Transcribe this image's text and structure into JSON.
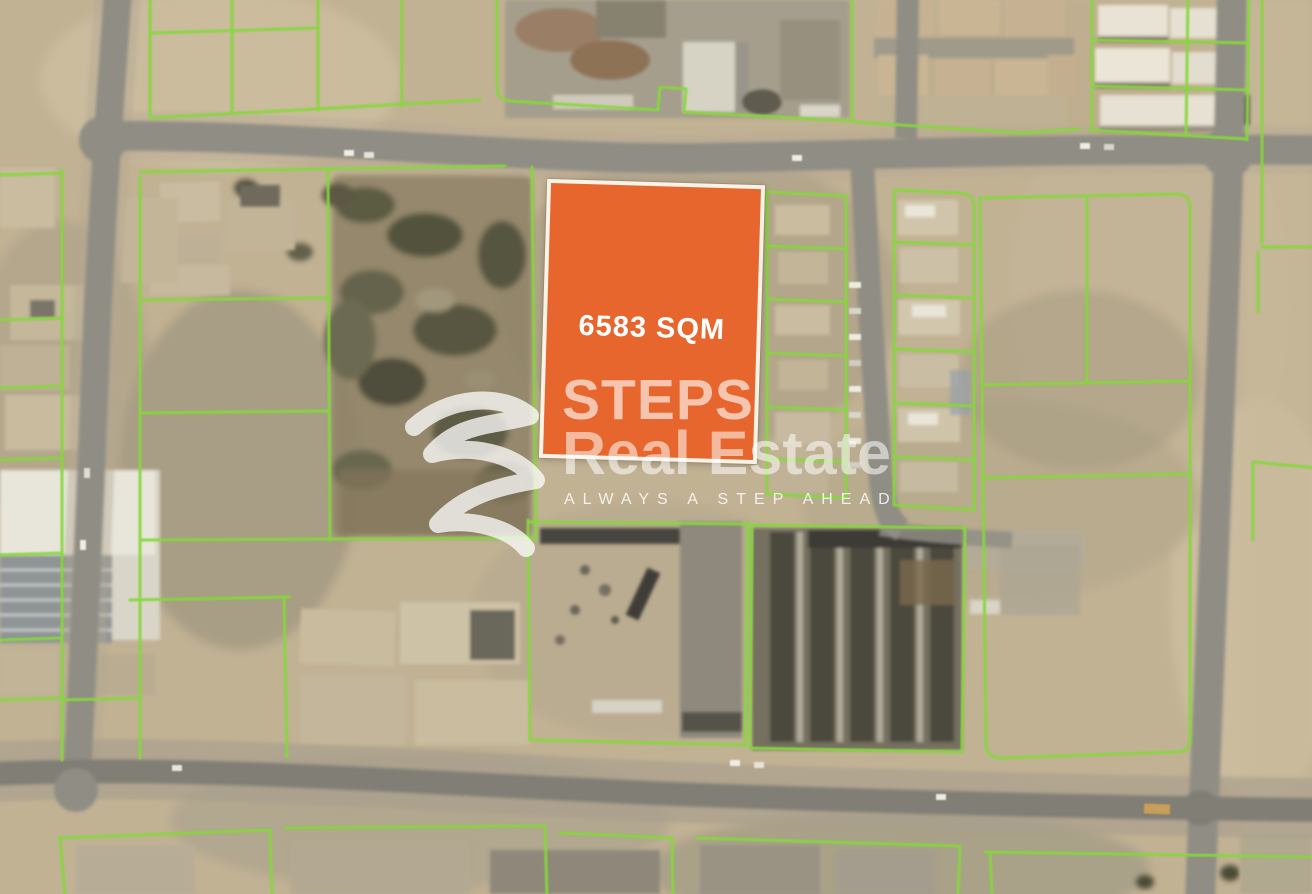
{
  "plot": {
    "area_label": "6583 SQM"
  },
  "watermark": {
    "brand_top": "STEPS",
    "brand_bottom": "Real Estate",
    "tagline": "ALWAYS A STEP AHEAD"
  },
  "colors": {
    "plot_fill": "#E6662E",
    "plot_border": "#F7F3E6",
    "boundary_green": "#86D73C",
    "road_gray": "#8F8D84",
    "sand_base": "#C2B294",
    "watermark_text": "#FFFFFF"
  }
}
